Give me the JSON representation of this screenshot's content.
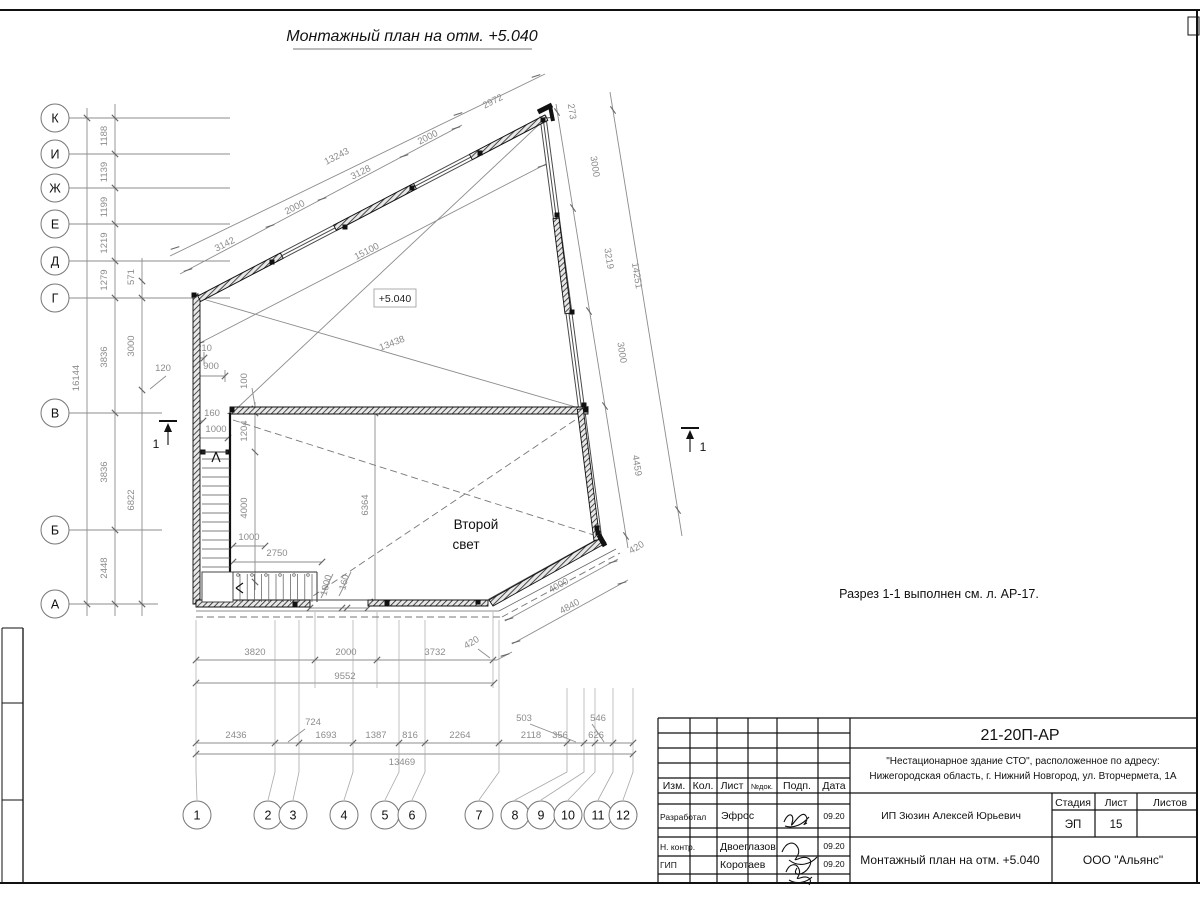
{
  "sheet": {
    "title": "Монтажный план на отм. +5.040",
    "note": "Разрез 1-1 выполнен см. л. АР-17.",
    "elevation_label": "+5.040",
    "room_label_1": "Второй",
    "room_label_2": "свет",
    "section_mark": "1"
  },
  "axes": {
    "left": [
      "К",
      "И",
      "Ж",
      "Е",
      "Д",
      "Г",
      "В",
      "Б",
      "А"
    ],
    "bottom": [
      "1",
      "2",
      "3",
      "4",
      "5",
      "6",
      "7",
      "8",
      "9",
      "10",
      "11",
      "12"
    ]
  },
  "dims": {
    "left_total": "16144",
    "left_seg": [
      "1188",
      "1139",
      "1199",
      "1219",
      "1279",
      "3836",
      "3836",
      "2448"
    ],
    "left_inner": [
      "571",
      "3000",
      "6822"
    ],
    "d120": "120",
    "d210": "210",
    "d900": "900",
    "d160a": "160",
    "d1000a": "1000",
    "d100": "100",
    "d1204": "1204",
    "d4000a": "4000",
    "d1000b": "1000",
    "d2750": "2750",
    "d1000c": "1000",
    "d160b": "160",
    "d6364": "6364",
    "top_total": "13243",
    "top_seg": [
      "3142",
      "2000",
      "3128",
      "2000"
    ],
    "d2972": "2972",
    "d15100": "15100",
    "d13438": "13438",
    "right_seg": [
      "273",
      "3000",
      "3219",
      "3000",
      "4459"
    ],
    "right_total": "14251",
    "d420a": "420",
    "d4000b": "4000",
    "d4840": "4840",
    "d420b": "420",
    "bottom_seg": [
      "3820",
      "2000",
      "3732"
    ],
    "bottom_total": "9552",
    "grid_seg": [
      "2436",
      "724",
      "1693",
      "1387",
      "816",
      "2264",
      "2118",
      "503",
      "356",
      "546",
      "626"
    ],
    "grid_total": "13469"
  },
  "titleblock": {
    "doc_number": "21-20П-АР",
    "project_line1": "\"Нестационарное здание СТО\", расположенное по адресу:",
    "project_line2": "Нижегородская область, г. Нижний Новгород, ул. Вторчермета, 1А",
    "client": "ИП Зюзин Алексей Юрьевич",
    "sheet_name": "Монтажный план на отм. +5.040",
    "organization": "ООО \"Альянс\"",
    "headers": {
      "izm": "Изм.",
      "kol": "Кол.",
      "list": "Лист",
      "ndok": "№док.",
      "podp": "Подп.",
      "data": "Дата",
      "stage": "Стадия",
      "sheet": "Лист",
      "sheets": "Листов"
    },
    "stage_value": "ЭП",
    "sheet_value": "15",
    "rows": [
      {
        "role": "Разработал",
        "name": "Эфрос",
        "date": "09.20"
      },
      {
        "role": "Н. контр.",
        "name": "Двоеглазов",
        "date": "09.20"
      },
      {
        "role": "ГИП",
        "name": "Коротаев",
        "date": "09.20"
      }
    ]
  }
}
